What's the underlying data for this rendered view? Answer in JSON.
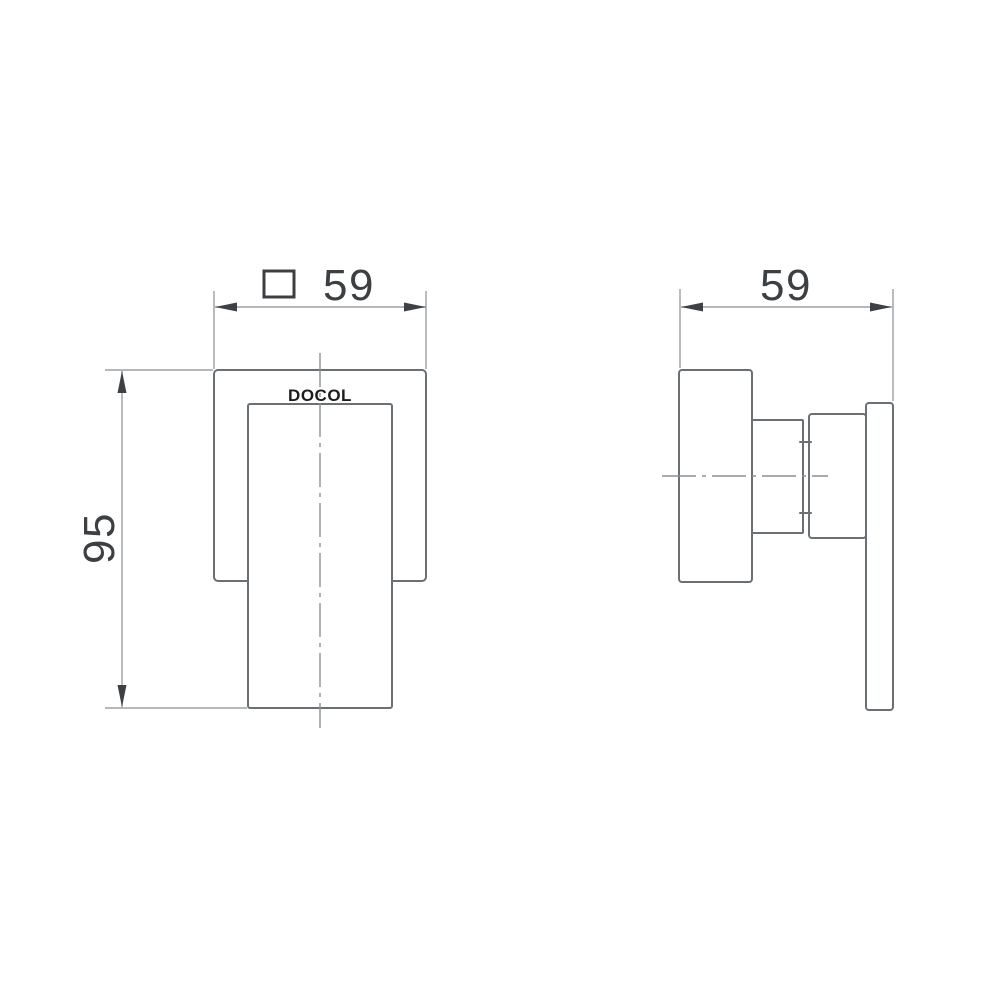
{
  "drawing": {
    "brand": "DOCOL",
    "front_view": {
      "name": "front view",
      "width_dimension": {
        "symbol": "square",
        "value": "59"
      },
      "height_dimension": {
        "value": "95"
      }
    },
    "side_view": {
      "name": "side view",
      "depth_dimension": {
        "value": "59"
      }
    },
    "colors": {
      "background": "#ffffff",
      "object_line": "#6b7074",
      "dimension_line": "#9aa0a3",
      "centerline": "#8b8f92",
      "dimension_text": "#3c4043",
      "brand_text": "#1c1c1e",
      "arrowhead": "#3e4144"
    }
  }
}
